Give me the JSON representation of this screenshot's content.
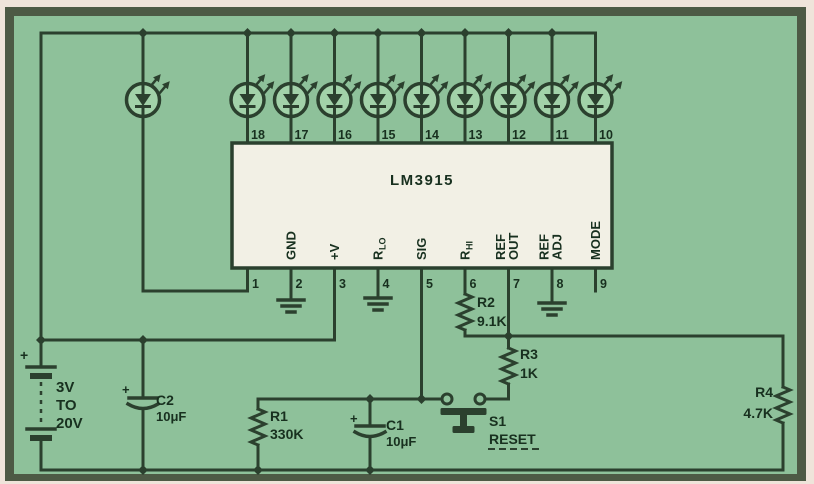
{
  "schematic": {
    "ic": {
      "name": "LM3915",
      "top_pins": [
        "18",
        "17",
        "16",
        "15",
        "14",
        "13",
        "12",
        "11",
        "10"
      ],
      "pins": [
        {
          "num": "1"
        },
        {
          "num": "2",
          "label": "GND"
        },
        {
          "num": "3",
          "label": "+V"
        },
        {
          "num": "4",
          "label_main": "R",
          "label_sub": "LO"
        },
        {
          "num": "5",
          "label": "SIG"
        },
        {
          "num": "6",
          "label_main": "R",
          "label_sub": "HI"
        },
        {
          "num": "7",
          "label_line1": "REF",
          "label_line2": "OUT"
        },
        {
          "num": "8",
          "label_line1": "REF",
          "label_line2": "ADJ"
        },
        {
          "num": "9",
          "label": "MODE"
        }
      ]
    },
    "battery": {
      "plus": "+",
      "line1": "3V",
      "line2": "TO",
      "line3": "20V"
    },
    "c1": {
      "plus": "+",
      "name": "C1",
      "value": "10μF"
    },
    "c2": {
      "plus": "+",
      "name": "C2",
      "value": "10μF"
    },
    "r1": {
      "name": "R1",
      "value": "330K"
    },
    "r2": {
      "name": "R2",
      "value": "9.1K"
    },
    "r3": {
      "name": "R3",
      "value": "1K"
    },
    "r4": {
      "name": "R4",
      "value": "4.7K"
    },
    "s1": {
      "name": "S1",
      "label": "RESET"
    }
  },
  "colors": {
    "background": "#8ec19a",
    "wire": "#2b402e",
    "ic_fill": "#f2f0e5",
    "led_fill": "#a2d2a9",
    "frame": "#4d5a45",
    "margin": "#efe4da"
  }
}
